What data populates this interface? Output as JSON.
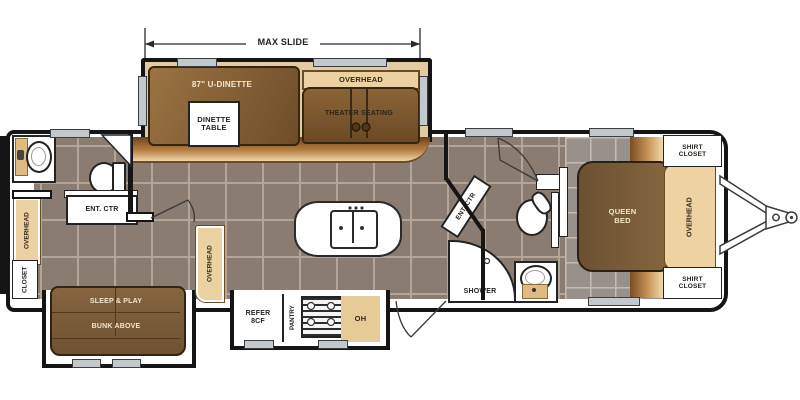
{
  "plan": {
    "dimension": {
      "label": "MAX SLIDE"
    },
    "slide_out": {
      "dinette_label": "87\" U-DINETTE",
      "dinette_table_label": "DINETTE TABLE",
      "overhead_label": "OVERHEAD",
      "theater_label": "THEATER SEATING"
    },
    "left_area": {
      "linen_label": "LIN",
      "ent_ctr_label": "ENT. CTR",
      "overhead_label": "OVERHEAD",
      "closet_label": "CLOSET"
    },
    "bunk_slide": {
      "line1": "SLEEP & PLAY",
      "line2": "BUNK ABOVE"
    },
    "kitchen": {
      "overhead_label": "OVERHEAD",
      "refer_label": "REFER 8CF",
      "pantry_label": "PANTRY",
      "oh_label": "OH"
    },
    "bath": {
      "ent_ctr_label": "ENT. CTR",
      "shower_label": "SHOWER"
    },
    "bedroom": {
      "bed_label": "QUEEN BED",
      "overhead_label": "OVERHEAD",
      "shirt_closet_top_label": "SHIRT CLOSET",
      "shirt_closet_bottom_label": "SHIRT CLOSET"
    },
    "colors": {
      "floor": "#8b7c71",
      "floor_grout": "#b3a698",
      "bedroom_floor": "#97908b",
      "wood_dark": "#7a5c3a",
      "wood_light": "#ecd2a2",
      "copper": "#b78042",
      "wall": "#151515",
      "window": "#c3c8cd"
    }
  }
}
